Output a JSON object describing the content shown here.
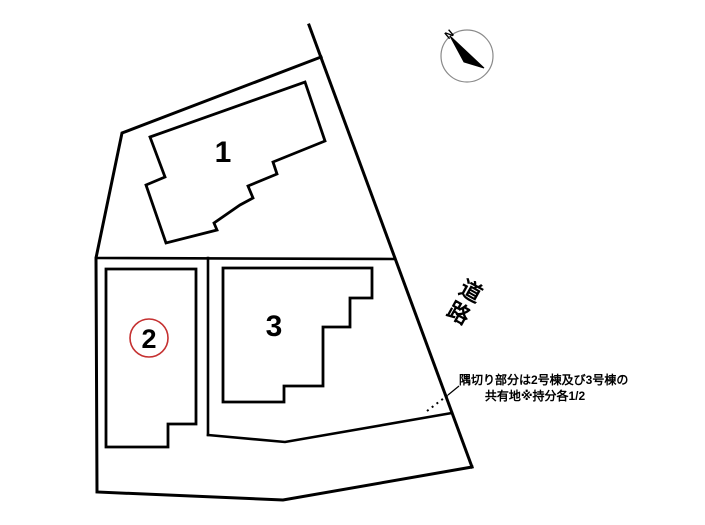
{
  "diagram": {
    "type": "residential-site-plan",
    "background_color": "#ffffff",
    "line_color": "#000000",
    "labels": {
      "lot1": "1",
      "lot2": "2",
      "lot3": "3",
      "north": "N",
      "road": [
        "道",
        "路"
      ]
    },
    "lot2_circle_color": "#c53030",
    "annotation": {
      "line1": "隅切り部分は2号棟及び3号棟の",
      "line2": "共有地※持分各1/2"
    }
  }
}
